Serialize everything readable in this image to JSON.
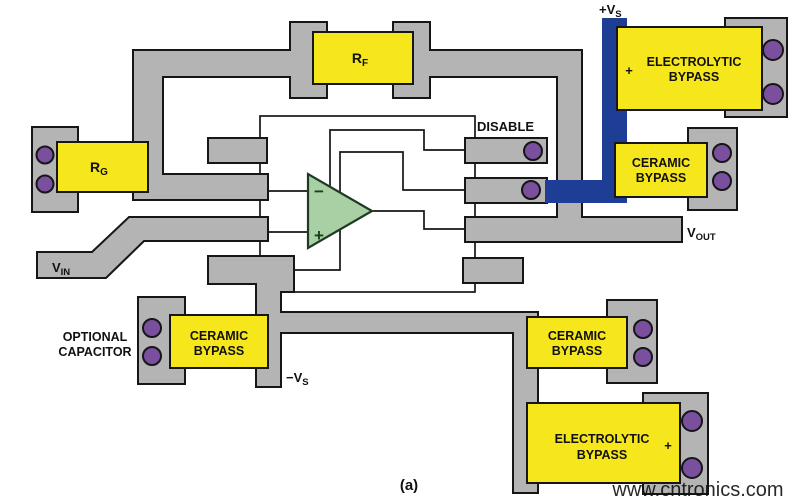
{
  "colors": {
    "background": "#ffffff",
    "trace": "#b4b4b4",
    "component_fill": "#f6e71d",
    "power_trace": "#1e3e95",
    "via": "#7a4f9e",
    "opamp_fill": "#a9d0a5",
    "outline": "#161616",
    "watermark": "#85d0a0"
  },
  "labels": {
    "vs_pos": {
      "main": "+V",
      "sub": "S"
    },
    "disable": "DISABLE",
    "vout": {
      "main": "V",
      "sub": "OUT"
    },
    "vin": {
      "main": "V",
      "sub": "IN"
    },
    "vs_neg": {
      "main": "−V",
      "sub": "S"
    },
    "optional_capacitor": {
      "line1": "OPTIONAL",
      "line2": "CAPACITOR"
    },
    "figure": "(a)"
  },
  "components": {
    "rf": {
      "main": "R",
      "sub": "F"
    },
    "rg": {
      "main": "R",
      "sub": "G"
    },
    "electrolytic_top": {
      "line1": "ELECTROLYTIC",
      "line2": "BYPASS",
      "polarity": "+"
    },
    "ceramic_top": {
      "line1": "CERAMIC",
      "line2": "BYPASS"
    },
    "ceramic_bottom_left": {
      "line1": "CERAMIC",
      "line2": "BYPASS"
    },
    "ceramic_bottom_right": {
      "line1": "CERAMIC",
      "line2": "BYPASS"
    },
    "electrolytic_bottom": {
      "line1": "ELECTROLYTIC",
      "line2": "BYPASS",
      "polarity": "+"
    }
  },
  "opamp": {
    "inverting_label": "−",
    "noninverting_label": "+"
  },
  "watermark": "www.cntronics.com"
}
